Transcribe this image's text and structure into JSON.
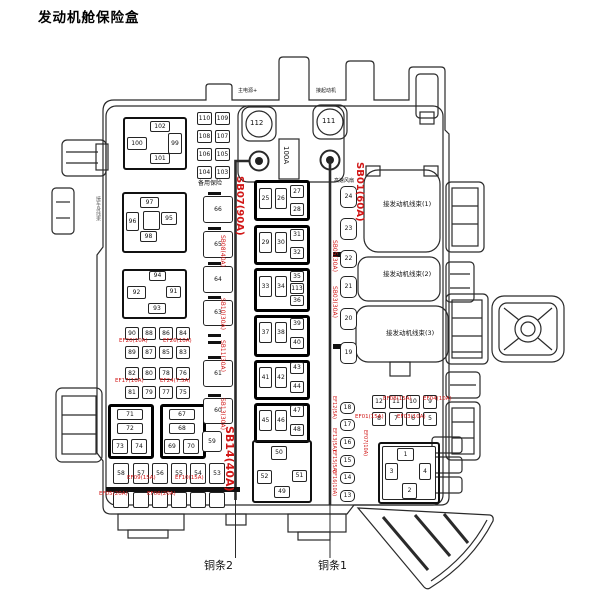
{
  "title": "发动机舱保险盒",
  "colors": {
    "annotation_red": "#d11616",
    "line_ink": "#2a2a2a"
  },
  "boxes": [
    [
      "",
      123,
      117,
      64,
      53,
      "f2"
    ],
    [
      "",
      122,
      192,
      65,
      61,
      "f2"
    ],
    [
      "",
      122,
      269,
      65,
      50,
      "f2"
    ],
    [
      "",
      108,
      404,
      46,
      55,
      "f"
    ],
    [
      "",
      160,
      404,
      46,
      55,
      "f"
    ],
    [
      "",
      254,
      180,
      56,
      41,
      "f"
    ],
    [
      "",
      254,
      225,
      56,
      40,
      "f"
    ],
    [
      "",
      254,
      268,
      56,
      44,
      "f"
    ],
    [
      "",
      254,
      315,
      56,
      42,
      "f"
    ],
    [
      "",
      254,
      360,
      56,
      40,
      "f"
    ],
    [
      "",
      254,
      403,
      56,
      40,
      "f"
    ],
    [
      "",
      252,
      440,
      60,
      63,
      "f2"
    ],
    [
      "",
      378,
      442,
      62,
      62,
      "f2"
    ],
    [
      "",
      382,
      446,
      54,
      54,
      ""
    ],
    [
      "",
      333,
      252,
      8,
      5,
      "blk"
    ],
    [
      "",
      333,
      344,
      8,
      5,
      "blk"
    ],
    [
      "102",
      150,
      121,
      20,
      11,
      ""
    ],
    [
      "100",
      127,
      137,
      20,
      13,
      ""
    ],
    [
      "99",
      168,
      133,
      14,
      21,
      ""
    ],
    [
      "101",
      150,
      153,
      20,
      11,
      ""
    ],
    [
      "110",
      197,
      112,
      15,
      13,
      ""
    ],
    [
      "109",
      215,
      112,
      15,
      13,
      ""
    ],
    [
      "108",
      197,
      130,
      15,
      13,
      ""
    ],
    [
      "107",
      215,
      130,
      15,
      13,
      ""
    ],
    [
      "106",
      197,
      148,
      15,
      13,
      ""
    ],
    [
      "105",
      215,
      148,
      15,
      13,
      ""
    ],
    [
      "104",
      197,
      166,
      15,
      13,
      ""
    ],
    [
      "103",
      215,
      166,
      15,
      13,
      ""
    ],
    [
      "97",
      140,
      197,
      19,
      11,
      ""
    ],
    [
      "96",
      126,
      212,
      13,
      19,
      ""
    ],
    [
      "",
      143,
      211,
      17,
      19,
      ""
    ],
    [
      "95",
      161,
      212,
      16,
      13,
      ""
    ],
    [
      "98",
      140,
      231,
      17,
      11,
      ""
    ],
    [
      "94",
      149,
      271,
      17,
      10,
      ""
    ],
    [
      "92",
      127,
      286,
      19,
      13,
      ""
    ],
    [
      "91",
      166,
      286,
      15,
      12,
      ""
    ],
    [
      "93",
      148,
      303,
      18,
      11,
      ""
    ],
    [
      "90",
      125,
      327,
      14,
      13,
      ""
    ],
    [
      "88",
      142,
      327,
      14,
      13,
      ""
    ],
    [
      "86",
      159,
      327,
      14,
      13,
      ""
    ],
    [
      "84",
      176,
      327,
      14,
      13,
      ""
    ],
    [
      "89",
      125,
      346,
      14,
      13,
      ""
    ],
    [
      "87",
      142,
      346,
      14,
      13,
      ""
    ],
    [
      "85",
      159,
      346,
      14,
      13,
      ""
    ],
    [
      "83",
      176,
      346,
      14,
      13,
      ""
    ],
    [
      "82",
      125,
      367,
      14,
      13,
      ""
    ],
    [
      "80",
      142,
      367,
      14,
      13,
      ""
    ],
    [
      "78",
      159,
      367,
      14,
      13,
      ""
    ],
    [
      "76",
      176,
      367,
      14,
      13,
      ""
    ],
    [
      "81",
      125,
      386,
      14,
      13,
      ""
    ],
    [
      "79",
      142,
      386,
      14,
      13,
      ""
    ],
    [
      "77",
      159,
      386,
      14,
      13,
      ""
    ],
    [
      "75",
      176,
      386,
      14,
      13,
      ""
    ],
    [
      "71",
      117,
      409,
      26,
      11,
      ""
    ],
    [
      "72",
      117,
      423,
      26,
      11,
      ""
    ],
    [
      "73",
      112,
      439,
      16,
      15,
      ""
    ],
    [
      "74",
      131,
      439,
      16,
      15,
      ""
    ],
    [
      "67",
      169,
      409,
      26,
      11,
      ""
    ],
    [
      "68",
      169,
      423,
      26,
      11,
      ""
    ],
    [
      "69",
      164,
      439,
      16,
      15,
      ""
    ],
    [
      "70",
      183,
      439,
      16,
      15,
      ""
    ],
    [
      "58",
      113,
      463,
      16,
      21,
      ""
    ],
    [
      "57",
      133,
      463,
      16,
      21,
      ""
    ],
    [
      "56",
      152,
      463,
      16,
      21,
      ""
    ],
    [
      "55",
      171,
      463,
      16,
      21,
      ""
    ],
    [
      "54",
      190,
      463,
      16,
      21,
      ""
    ],
    [
      "53",
      209,
      463,
      16,
      21,
      ""
    ],
    [
      "",
      113,
      492,
      16,
      16,
      ""
    ],
    [
      "",
      133,
      492,
      16,
      16,
      ""
    ],
    [
      "",
      152,
      492,
      16,
      16,
      ""
    ],
    [
      "",
      171,
      492,
      16,
      16,
      ""
    ],
    [
      "",
      190,
      492,
      16,
      16,
      ""
    ],
    [
      "",
      209,
      492,
      16,
      16,
      ""
    ],
    [
      "66",
      203,
      196,
      30,
      27,
      "m"
    ],
    [
      "65",
      203,
      231,
      30,
      27,
      "m"
    ],
    [
      "64",
      203,
      266,
      30,
      27,
      "m"
    ],
    [
      "63",
      203,
      300,
      30,
      26,
      "m"
    ],
    [
      "61",
      203,
      360,
      30,
      27,
      "m"
    ],
    [
      "60",
      203,
      398,
      30,
      26,
      "m"
    ],
    [
      "59",
      202,
      431,
      20,
      21,
      "m"
    ],
    [
      "25",
      259,
      188,
      13,
      21,
      ""
    ],
    [
      "26",
      275,
      188,
      12,
      21,
      ""
    ],
    [
      "27",
      290,
      185,
      14,
      13,
      ""
    ],
    [
      "28",
      290,
      203,
      14,
      13,
      ""
    ],
    [
      "29",
      259,
      232,
      13,
      21,
      ""
    ],
    [
      "30",
      275,
      232,
      12,
      21,
      ""
    ],
    [
      "31",
      290,
      229,
      14,
      12,
      ""
    ],
    [
      "32",
      290,
      247,
      14,
      12,
      ""
    ],
    [
      "33",
      259,
      276,
      13,
      21,
      ""
    ],
    [
      "34",
      275,
      276,
      12,
      21,
      ""
    ],
    [
      "35",
      290,
      271,
      14,
      11,
      ""
    ],
    [
      "113",
      290,
      283,
      14,
      11,
      ""
    ],
    [
      "36",
      290,
      295,
      14,
      11,
      ""
    ],
    [
      "37",
      259,
      322,
      13,
      21,
      ""
    ],
    [
      "38",
      275,
      322,
      12,
      21,
      ""
    ],
    [
      "39",
      290,
      318,
      14,
      12,
      ""
    ],
    [
      "40",
      290,
      337,
      14,
      12,
      ""
    ],
    [
      "41",
      259,
      367,
      13,
      21,
      ""
    ],
    [
      "42",
      275,
      367,
      12,
      21,
      ""
    ],
    [
      "43",
      290,
      362,
      14,
      12,
      ""
    ],
    [
      "44",
      290,
      381,
      14,
      12,
      ""
    ],
    [
      "45",
      259,
      410,
      13,
      21,
      ""
    ],
    [
      "46",
      275,
      410,
      12,
      21,
      ""
    ],
    [
      "47",
      290,
      405,
      14,
      12,
      ""
    ],
    [
      "48",
      290,
      424,
      14,
      12,
      ""
    ],
    [
      "50",
      271,
      446,
      16,
      14,
      ""
    ],
    [
      "52",
      257,
      470,
      15,
      14,
      ""
    ],
    [
      "51",
      292,
      470,
      15,
      12,
      ""
    ],
    [
      "49",
      274,
      486,
      16,
      12,
      ""
    ],
    [
      "24",
      340,
      186,
      17,
      22,
      "rd"
    ],
    [
      "23",
      340,
      218,
      17,
      22,
      "rd"
    ],
    [
      "22",
      340,
      250,
      17,
      18,
      "rd"
    ],
    [
      "21",
      340,
      276,
      17,
      22,
      "rd"
    ],
    [
      "20",
      340,
      308,
      17,
      22,
      "rd"
    ],
    [
      "19",
      340,
      342,
      17,
      22,
      "rd"
    ],
    [
      "18",
      340,
      402,
      15,
      12,
      "rd"
    ],
    [
      "17",
      340,
      419,
      15,
      12,
      "rd"
    ],
    [
      "16",
      340,
      437,
      15,
      12,
      "rd"
    ],
    [
      "15",
      340,
      455,
      15,
      12,
      "rd"
    ],
    [
      "14",
      340,
      472,
      15,
      12,
      "rd"
    ],
    [
      "13",
      340,
      490,
      15,
      12,
      "rd"
    ],
    [
      "12",
      372,
      395,
      14,
      14,
      ""
    ],
    [
      "11",
      389,
      395,
      14,
      14,
      ""
    ],
    [
      "10",
      406,
      395,
      14,
      14,
      ""
    ],
    [
      "9",
      423,
      395,
      14,
      14,
      ""
    ],
    [
      "8",
      372,
      412,
      14,
      14,
      ""
    ],
    [
      "7",
      389,
      412,
      14,
      14,
      ""
    ],
    [
      "6",
      406,
      412,
      14,
      14,
      ""
    ],
    [
      "5",
      423,
      412,
      14,
      14,
      ""
    ],
    [
      "1",
      397,
      448,
      17,
      13,
      ""
    ],
    [
      "3",
      385,
      463,
      13,
      17,
      ""
    ],
    [
      "4",
      419,
      463,
      12,
      17,
      ""
    ],
    [
      "2",
      402,
      483,
      15,
      16,
      ""
    ]
  ],
  "texts": [
    [
      "112",
      250,
      120,
      7,
      0,
      0,
      0
    ],
    [
      "111",
      322,
      118,
      7,
      0,
      0,
      0
    ],
    [
      "100A",
      282,
      146,
      7,
      0,
      1,
      0
    ],
    [
      "备用保险",
      198,
      181,
      6,
      0,
      0,
      0
    ],
    [
      "主电源+",
      238,
      89,
      5,
      0,
      0,
      0
    ],
    [
      "接起动机",
      316,
      89,
      5,
      0,
      0,
      0
    ],
    [
      "高速风扇",
      334,
      179,
      5,
      0,
      0,
      0
    ],
    [
      "SB07(90A)",
      234,
      176,
      10,
      1,
      1,
      1
    ],
    [
      "SB01(60A)",
      354,
      162,
      10,
      1,
      1,
      1
    ],
    [
      "SB14(40A)",
      224,
      426,
      11,
      1,
      1,
      1
    ],
    [
      "SB08(40A)",
      219,
      235,
      6,
      1,
      1,
      0
    ],
    [
      "SB10(30A)",
      219,
      298,
      6,
      1,
      1,
      0
    ],
    [
      "SB11(30A)",
      219,
      340,
      6,
      1,
      1,
      0
    ],
    [
      "SB13(30A)",
      219,
      398,
      6,
      1,
      1,
      0
    ],
    [
      "SB05(30A)",
      331,
      240,
      6,
      1,
      1,
      0
    ],
    [
      "SB03(30A)",
      331,
      286,
      6,
      1,
      1,
      0
    ],
    [
      "EF20(10A)",
      119,
      339,
      5.5,
      1,
      0,
      0
    ],
    [
      "EF26(10A)",
      163,
      339,
      5.5,
      1,
      0,
      0
    ],
    [
      "EF17(10A)",
      115,
      379,
      5.5,
      1,
      0,
      0
    ],
    [
      "EF24(7.5A)",
      160,
      379,
      5.5,
      1,
      0,
      0
    ],
    [
      "EF09(15A)",
      127,
      476,
      5.5,
      1,
      0,
      0
    ],
    [
      "EF10(15A)",
      175,
      476,
      5.5,
      1,
      0,
      0
    ],
    [
      "EF05(20A)",
      99,
      492,
      5.5,
      1,
      0,
      0
    ],
    [
      "EF06(20A)",
      147,
      492,
      5.5,
      1,
      0,
      0
    ],
    [
      "EF08(15A)",
      383,
      397,
      5.5,
      1,
      0,
      0
    ],
    [
      "EF04(10A)",
      423,
      397,
      5.5,
      1,
      0,
      0
    ],
    [
      "EF01(15A)",
      355,
      415,
      5.5,
      1,
      0,
      0
    ],
    [
      "EF03(10A)",
      397,
      415,
      5.5,
      1,
      0,
      0
    ],
    [
      "EF12(5A)",
      331,
      396,
      5,
      1,
      1,
      0
    ],
    [
      "EF13(5A)",
      331,
      428,
      5,
      1,
      1,
      0
    ],
    [
      "EF15(5A)",
      331,
      450,
      5,
      1,
      1,
      0
    ],
    [
      "EF16(10A)",
      331,
      470,
      5,
      1,
      1,
      0
    ],
    [
      "EF07(10A)",
      362,
      430,
      5,
      1,
      1,
      0
    ],
    [
      "接发动机线束(1)",
      383,
      201,
      6.5,
      0,
      0,
      0
    ],
    [
      "接发动机线束(2)",
      383,
      271,
      6.5,
      0,
      0,
      0
    ],
    [
      "接发动机线束(3)",
      386,
      330,
      6.5,
      0,
      0,
      0
    ],
    [
      "接车身线束",
      95,
      196,
      5,
      2,
      1,
      0
    ],
    [
      "铜条2",
      204,
      560,
      11,
      0,
      0,
      0
    ],
    [
      "铜条1",
      318,
      560,
      11,
      0,
      0,
      0
    ]
  ]
}
